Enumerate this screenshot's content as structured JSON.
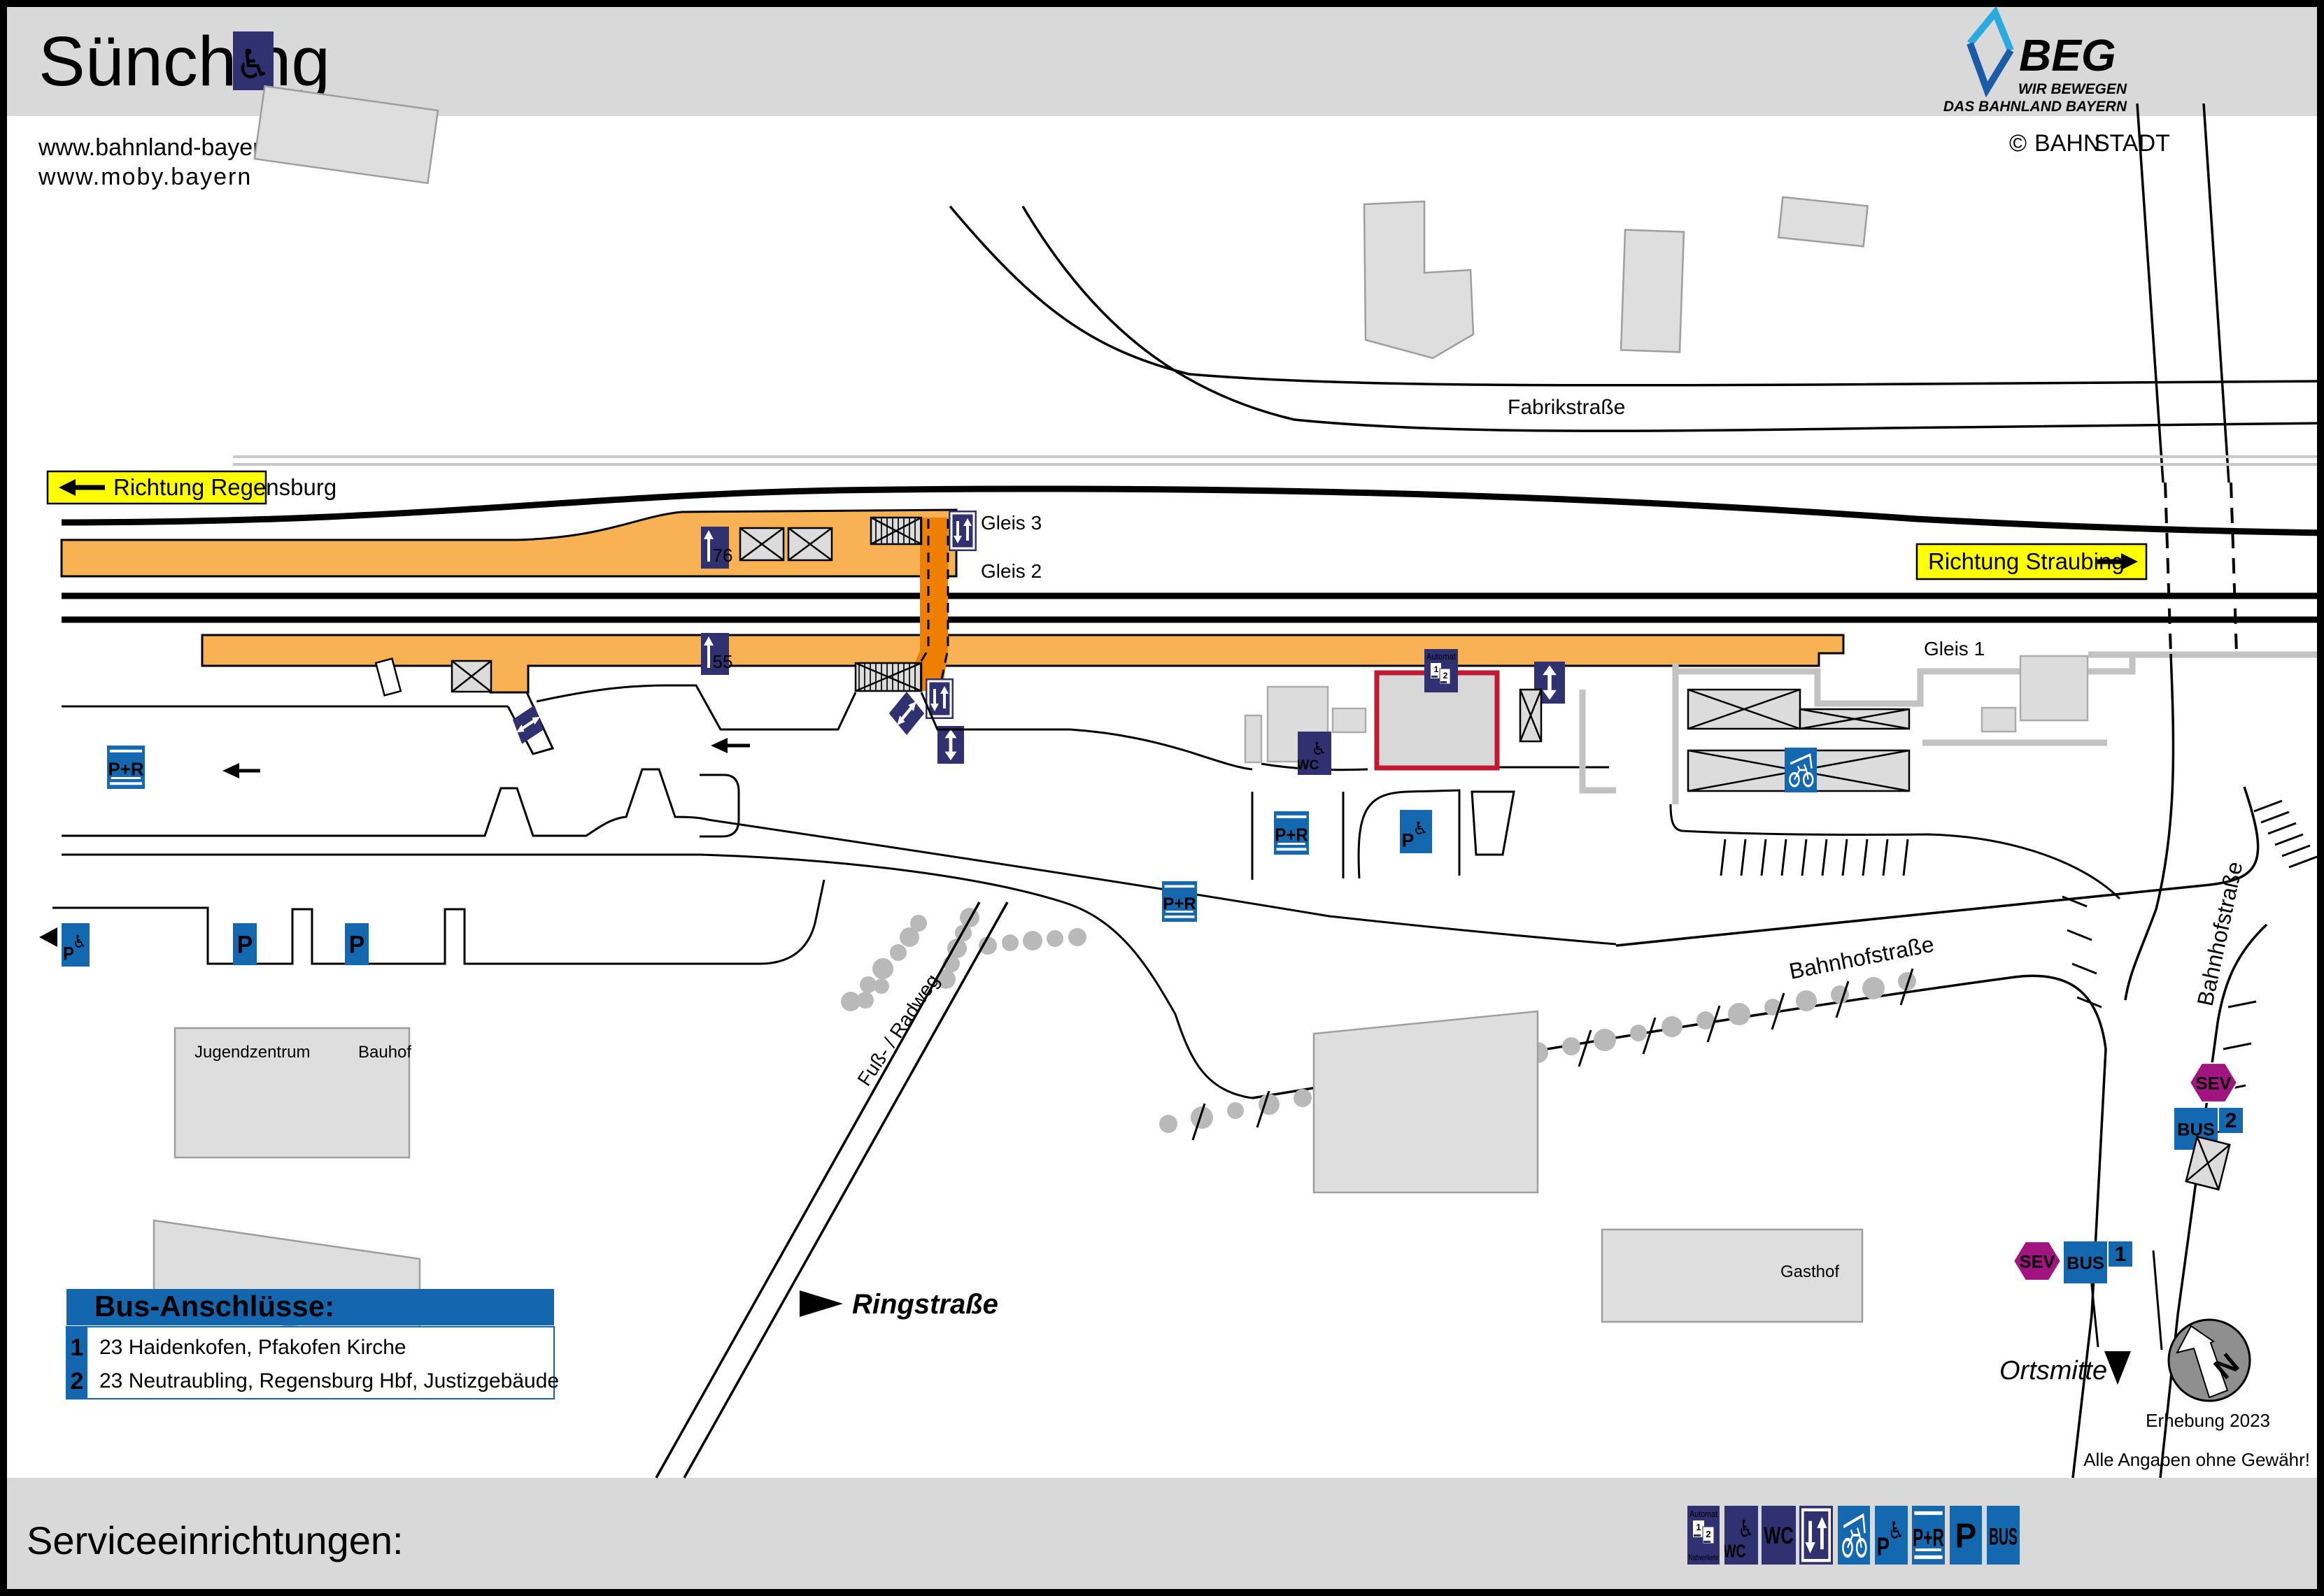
{
  "header": {
    "title": "Sünching",
    "url1": "www.bahnland-bayern.de",
    "url2": "www.moby.bayern",
    "beg_name": "BEG",
    "beg_tagline1": "WIR BEWEGEN",
    "beg_tagline2": "DAS BAHNLAND BAYERN",
    "credit_symbol": "©",
    "credit_part1": "BAHN",
    "credit_part2": "STADT"
  },
  "footer": {
    "label": "Serviceeinrichtungen:"
  },
  "directions": {
    "regensburg": "Richtung Regensburg",
    "straubing": "Richtung Straubing"
  },
  "tracks": {
    "gleis1": "Gleis 1",
    "gleis2": "Gleis 2",
    "gleis3": "Gleis 3"
  },
  "platform_heights": {
    "p76": "76",
    "p55": "55"
  },
  "streets": {
    "fabrikstrasse": "Fabrikstraße",
    "bahnhofstrasse": "Bahnhofstraße",
    "fussradweg": "Fuß- / Radweg",
    "ringstrasse": "Ringstraße",
    "ortsmitte": "Ortsmitte"
  },
  "buildings": {
    "jugendzentrum": "Jugendzentrum",
    "bauhof": "Bauhof",
    "gasthof": "Gasthof"
  },
  "icons": {
    "wheelchair": "♿",
    "automat": "Automat",
    "nahverkehr": "Nahverkehr",
    "wc": "WC",
    "pr": "P+R",
    "p": "P",
    "bus": "BUS",
    "sev": "SEV",
    "ticket1": "1",
    "ticket2": "2"
  },
  "bus_stops": {
    "stop1": "1",
    "stop2": "2"
  },
  "bus_legend": {
    "title": "Bus-Anschlüsse:",
    "rows": [
      {
        "no": "1",
        "route": "23 Haidenkofen, Pfakofen Kirche"
      },
      {
        "no": "2",
        "route": "23 Neutraubling, Regensburg Hbf, Justizgebäude"
      }
    ]
  },
  "notes": {
    "survey": "Erhebung 2023",
    "disclaimer": "Alle Angaben ohne Gewähr!",
    "north": "N"
  }
}
